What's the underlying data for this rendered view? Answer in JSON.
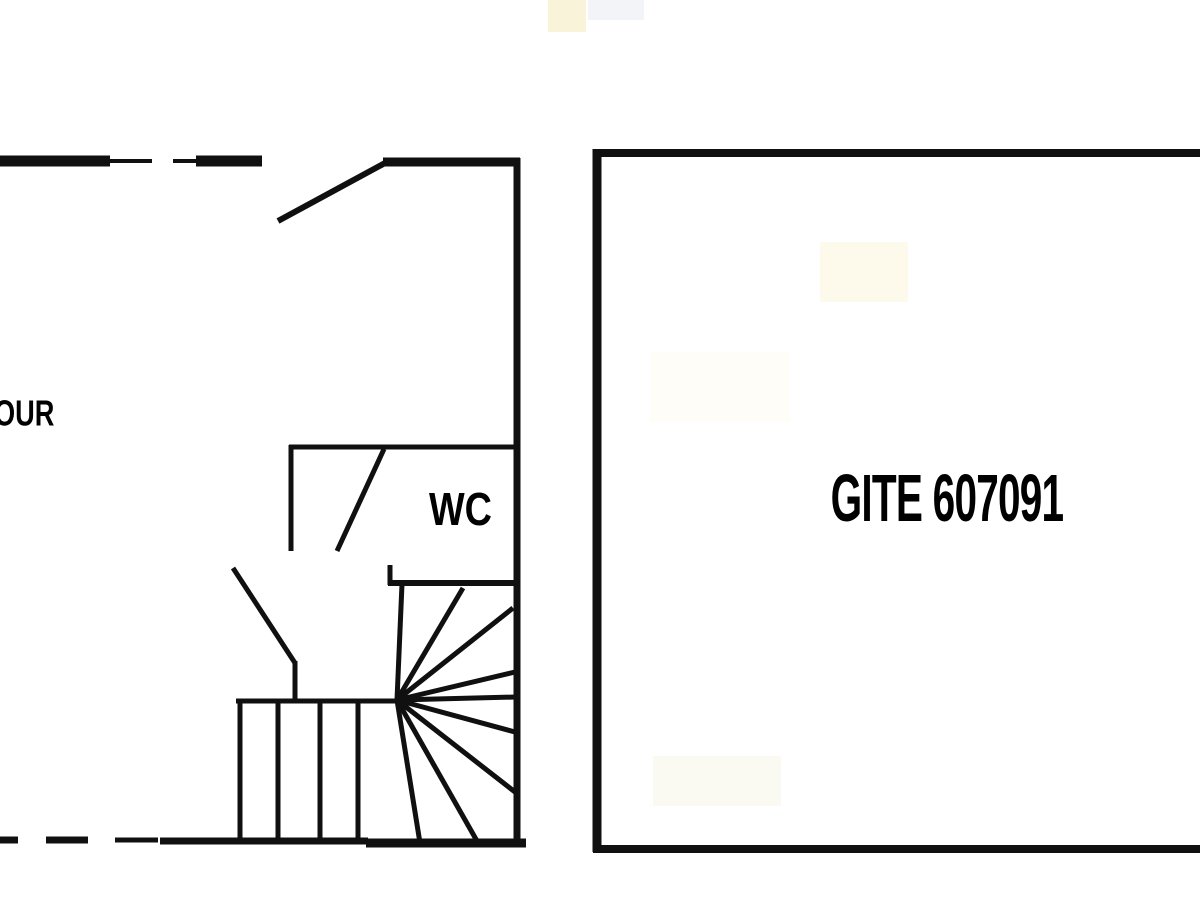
{
  "page": {
    "type": "floor-plan",
    "background_color": "#ffffff",
    "wall_color": "#101010",
    "label_color": "#000000"
  },
  "labels": {
    "courtyard_partial": "OUR",
    "wc": "WC",
    "gite": "GITE 607091"
  },
  "plan": {
    "left_building": {
      "rooms": [
        "main room (label cut off at edge: OUR)",
        "WC"
      ],
      "features": [
        "entry door swing top wall",
        "wc door swing",
        "winder spiral staircase",
        "straight staircase",
        "dashed wall segments top-left and bottom-left"
      ]
    },
    "right_building": {
      "rooms": [
        "GITE 607091"
      ],
      "features": [
        "rectangular outline open at right image edge"
      ]
    }
  }
}
